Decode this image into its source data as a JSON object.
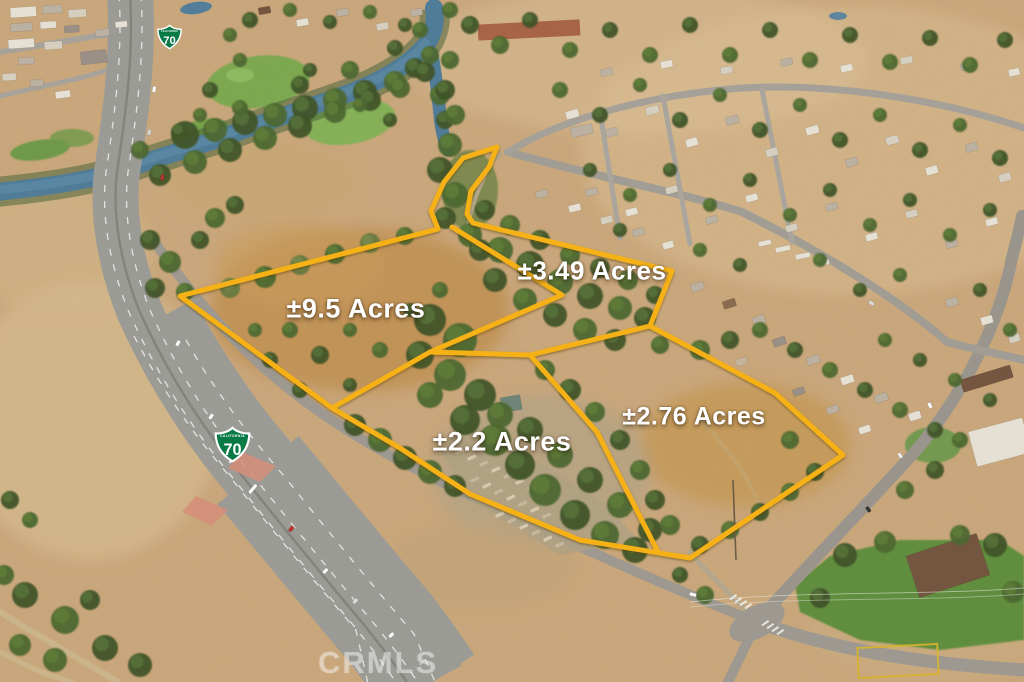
{
  "parcels": [
    {
      "label": "±9.5 Acres"
    },
    {
      "label": "±3.49 Acres"
    },
    {
      "label": "±2.2 Acres"
    },
    {
      "label": "±2.76 Acres"
    }
  ],
  "boundary": {
    "color": "#F5B119"
  },
  "route_shields": [
    {
      "state": "CALIFORNIA",
      "route": "70"
    },
    {
      "state": "CALIFORNIA",
      "route": "70"
    }
  ],
  "route_shield_style": {
    "green": "#077A46",
    "border": "#FFFFFF"
  },
  "watermark": {
    "text": "CRMLS"
  }
}
